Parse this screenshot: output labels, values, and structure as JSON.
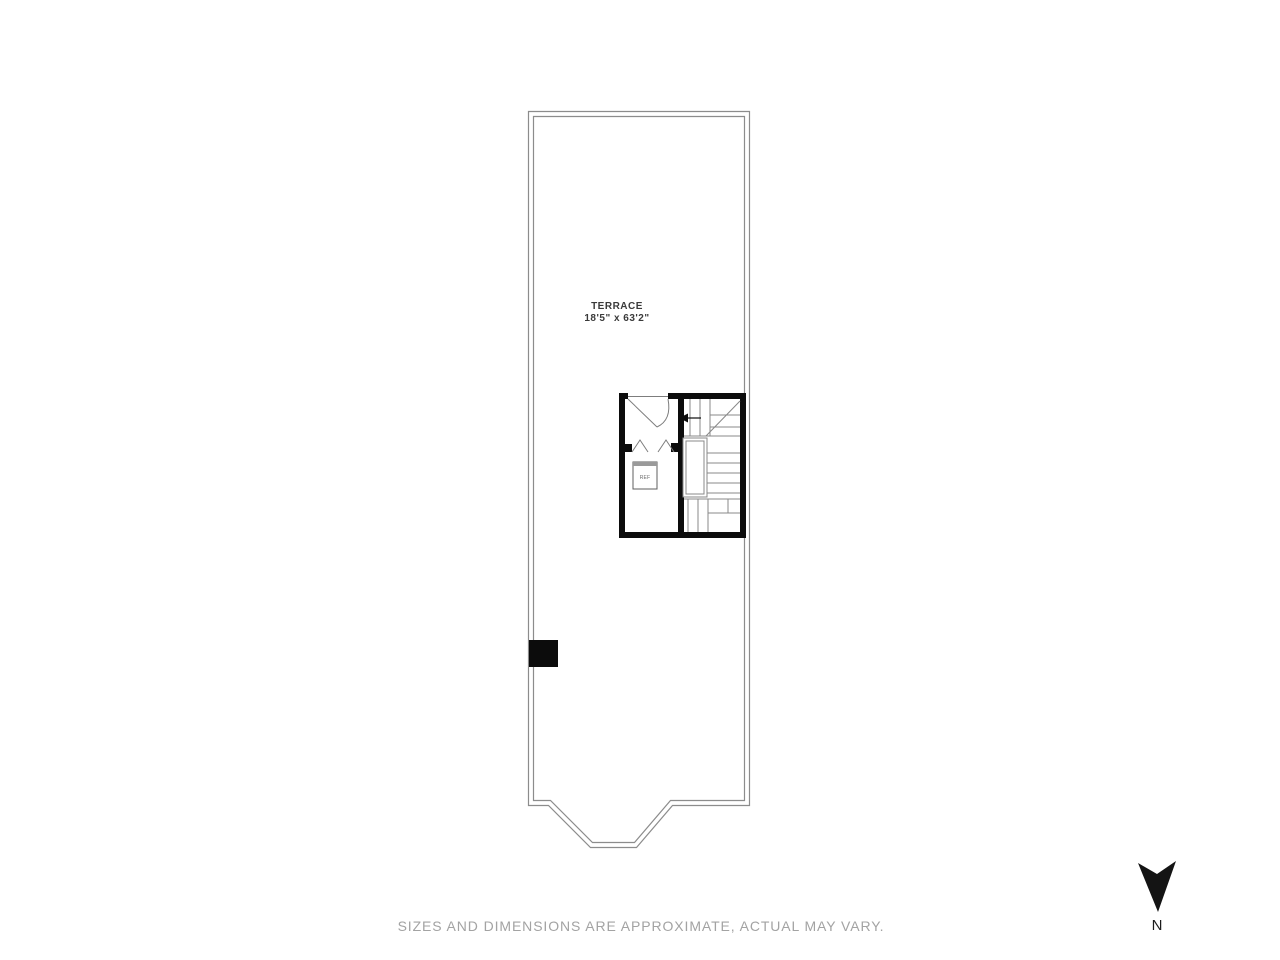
{
  "page": {
    "background_color": "#ffffff",
    "disclaimer": "SIZES AND DIMENSIONS ARE APPROXIMATE, ACTUAL MAY VARY."
  },
  "floor_plan": {
    "type": "terrace-roof-level-plan",
    "room": {
      "name": "TERRACE",
      "dimensions": "18'5\" x 63'2\""
    },
    "appliance": {
      "label": "REF"
    },
    "compass": {
      "label": "N",
      "note": "arrow points toward bottom of page"
    },
    "colors": {
      "thin_wall_line": "#8c8c8c",
      "bold_wall": "#0c0c0c",
      "stair_line": "#888888",
      "room_label_text": "#3a3a3a",
      "disclaimer_text": "#a3a3a3"
    }
  }
}
